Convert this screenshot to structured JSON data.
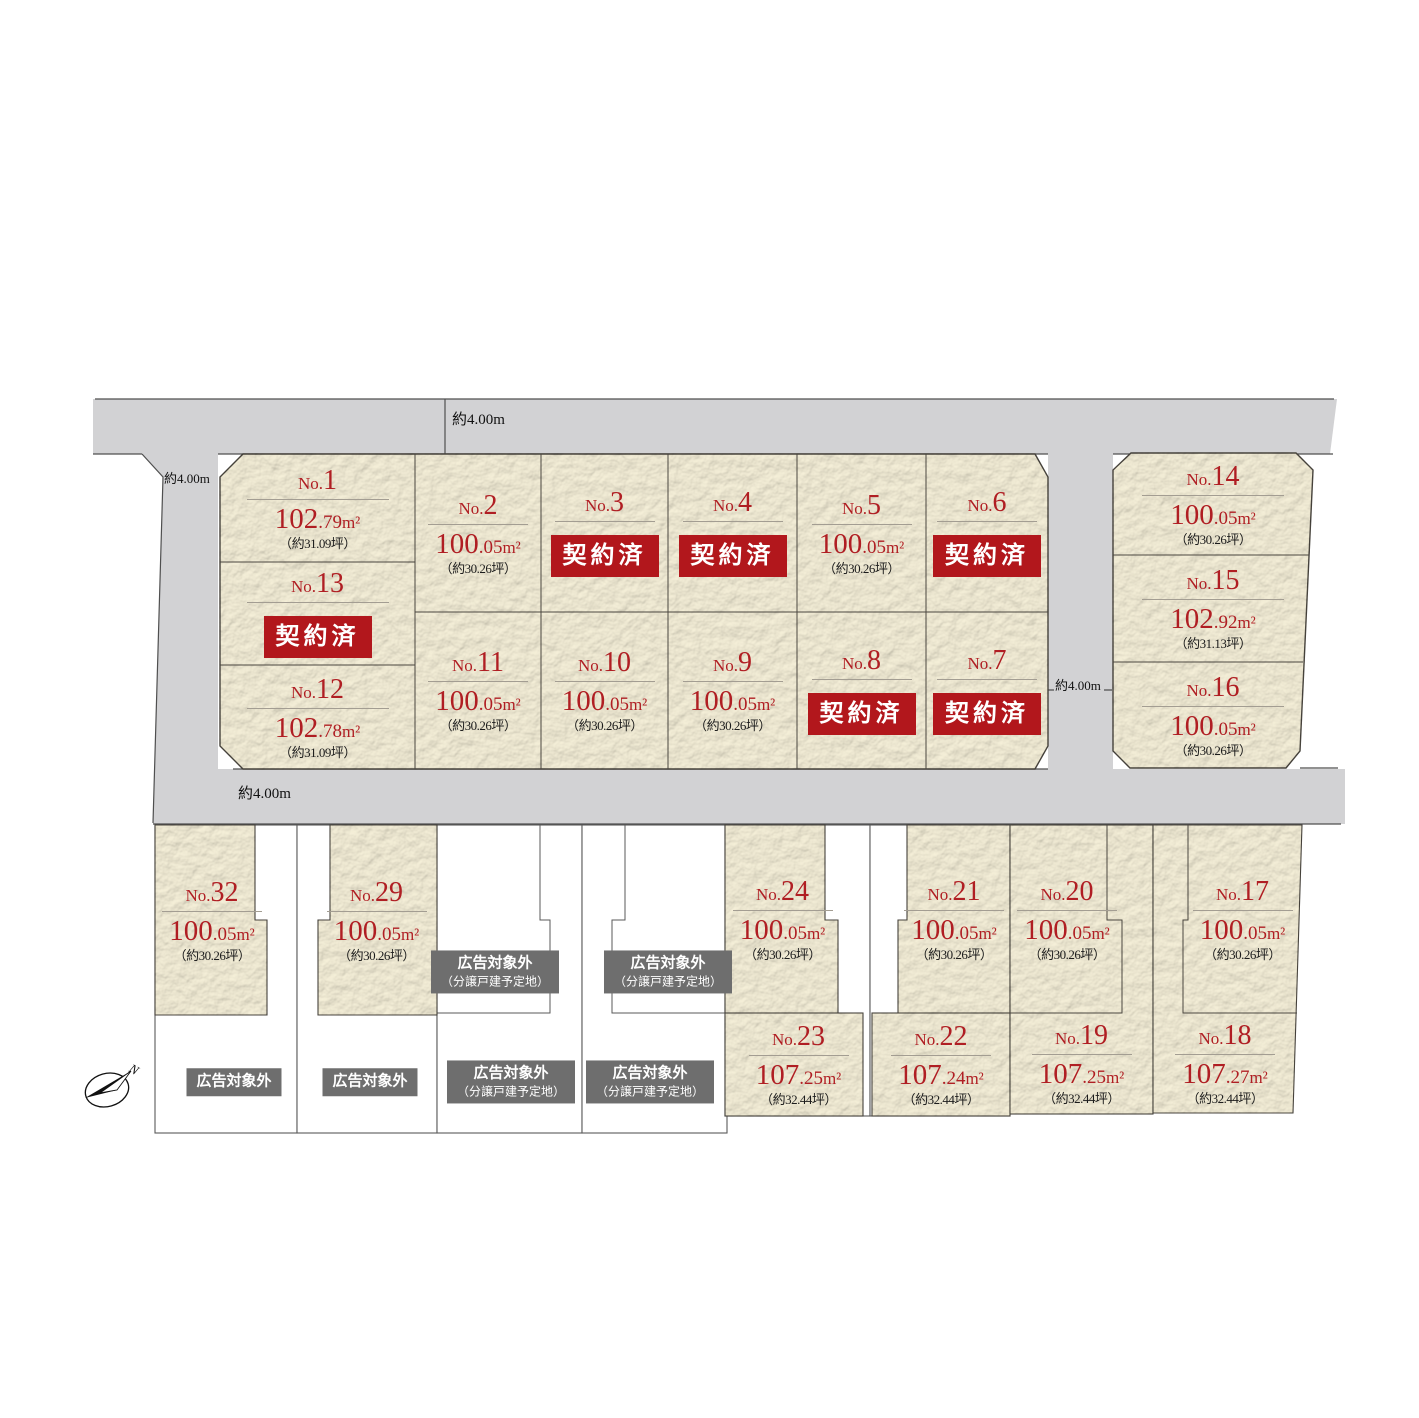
{
  "roads": {
    "width_label": "約4.00m"
  },
  "legend": {
    "sold": "契約済",
    "excluded": "広告対象外",
    "excluded_sub": "（分譲戸建予定地）"
  },
  "units": {
    "m2": "m²"
  },
  "compass": {
    "north": "N"
  },
  "colors": {
    "lot_fill": "#f6f0d9",
    "road_fill": "#d2d2d4",
    "accent_red": "#b01e23",
    "badge_bg": "#b2171c",
    "gray_label_bg": "#6e6e6e",
    "boundary_line": "#4a463f"
  },
  "lots": [
    {
      "no": {
        "prefix": "No.",
        "num": "1"
      },
      "area": {
        "int": "102",
        "frac": ".79"
      },
      "tsubo": "（約31.09坪）"
    },
    {
      "no": {
        "prefix": "No.",
        "num": "2"
      },
      "area": {
        "int": "100",
        "frac": ".05"
      },
      "tsubo": "（約30.26坪）"
    },
    {
      "no": {
        "prefix": "No.",
        "num": "3"
      },
      "status": "契約済"
    },
    {
      "no": {
        "prefix": "No.",
        "num": "4"
      },
      "status": "契約済"
    },
    {
      "no": {
        "prefix": "No.",
        "num": "5"
      },
      "area": {
        "int": "100",
        "frac": ".05"
      },
      "tsubo": "（約30.26坪）"
    },
    {
      "no": {
        "prefix": "No.",
        "num": "6"
      },
      "status": "契約済"
    },
    {
      "no": {
        "prefix": "No.",
        "num": "7"
      },
      "status": "契約済"
    },
    {
      "no": {
        "prefix": "No.",
        "num": "8"
      },
      "status": "契約済"
    },
    {
      "no": {
        "prefix": "No.",
        "num": "9"
      },
      "area": {
        "int": "100",
        "frac": ".05"
      },
      "tsubo": "（約30.26坪）"
    },
    {
      "no": {
        "prefix": "No.",
        "num": "10"
      },
      "area": {
        "int": "100",
        "frac": ".05"
      },
      "tsubo": "（約30.26坪）"
    },
    {
      "no": {
        "prefix": "No.",
        "num": "11"
      },
      "area": {
        "int": "100",
        "frac": ".05"
      },
      "tsubo": "（約30.26坪）"
    },
    {
      "no": {
        "prefix": "No.",
        "num": "12"
      },
      "area": {
        "int": "102",
        "frac": ".78"
      },
      "tsubo": "（約31.09坪）"
    },
    {
      "no": {
        "prefix": "No.",
        "num": "13"
      },
      "status": "契約済"
    },
    {
      "no": {
        "prefix": "No.",
        "num": "14"
      },
      "area": {
        "int": "100",
        "frac": ".05"
      },
      "tsubo": "（約30.26坪）"
    },
    {
      "no": {
        "prefix": "No.",
        "num": "15"
      },
      "area": {
        "int": "102",
        "frac": ".92"
      },
      "tsubo": "（約31.13坪）"
    },
    {
      "no": {
        "prefix": "No.",
        "num": "16"
      },
      "area": {
        "int": "100",
        "frac": ".05"
      },
      "tsubo": "（約30.26坪）"
    },
    {
      "no": {
        "prefix": "No.",
        "num": "17"
      },
      "area": {
        "int": "100",
        "frac": ".05"
      },
      "tsubo": "（約30.26坪）"
    },
    {
      "no": {
        "prefix": "No.",
        "num": "18"
      },
      "area": {
        "int": "107",
        "frac": ".27"
      },
      "tsubo": "（約32.44坪）"
    },
    {
      "no": {
        "prefix": "No.",
        "num": "19"
      },
      "area": {
        "int": "107",
        "frac": ".25"
      },
      "tsubo": "（約32.44坪）"
    },
    {
      "no": {
        "prefix": "No.",
        "num": "20"
      },
      "area": {
        "int": "100",
        "frac": ".05"
      },
      "tsubo": "（約30.26坪）"
    },
    {
      "no": {
        "prefix": "No.",
        "num": "21"
      },
      "area": {
        "int": "100",
        "frac": ".05"
      },
      "tsubo": "（約30.26坪）"
    },
    {
      "no": {
        "prefix": "No.",
        "num": "22"
      },
      "area": {
        "int": "107",
        "frac": ".24"
      },
      "tsubo": "（約32.44坪）"
    },
    {
      "no": {
        "prefix": "No.",
        "num": "23"
      },
      "area": {
        "int": "107",
        "frac": ".25"
      },
      "tsubo": "（約32.44坪）"
    },
    {
      "no": {
        "prefix": "No.",
        "num": "24"
      },
      "area": {
        "int": "100",
        "frac": ".05"
      },
      "tsubo": "（約30.26坪）"
    },
    {
      "no": {
        "prefix": "No.",
        "num": "29"
      },
      "area": {
        "int": "100",
        "frac": ".05"
      },
      "tsubo": "（約30.26坪）"
    },
    {
      "no": {
        "prefix": "No.",
        "num": "32"
      },
      "area": {
        "int": "100",
        "frac": ".05"
      },
      "tsubo": "（約30.26坪）"
    }
  ]
}
